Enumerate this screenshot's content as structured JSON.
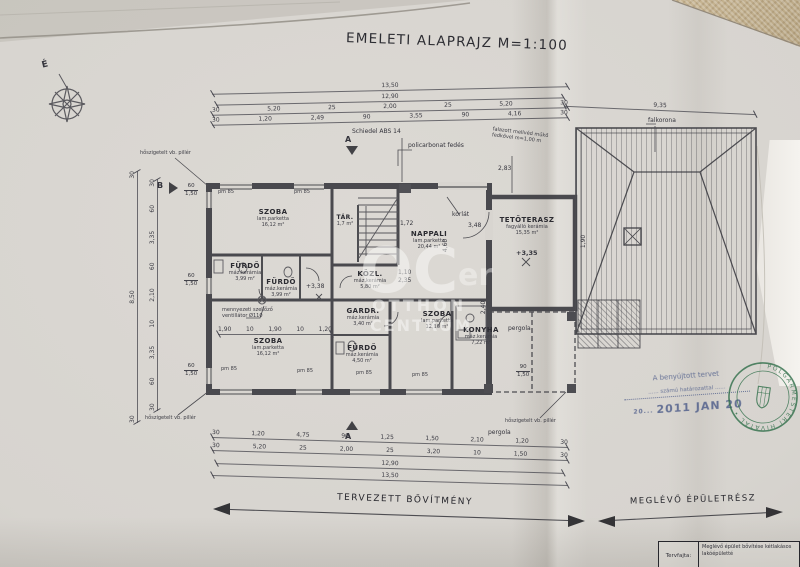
{
  "title": "EMELETI ALAPRAJZ M=1:100",
  "compass_label": "É",
  "watermark": {
    "big": "OC",
    "line1": "OTTHON",
    "line2": "CENTRUM",
    "fragment": "er"
  },
  "rooms": [
    {
      "name": "SZOBA",
      "finish": "lam.parketta",
      "area": "16,12 m²"
    },
    {
      "name": "TÁR.",
      "finish": "",
      "area": "1,7 m²"
    },
    {
      "name": "NAPPALI",
      "finish": "lam.parketta",
      "area": "20,44 m²"
    },
    {
      "name": "TETŐTERASZ",
      "finish": "fagyálló kerámia",
      "area": "15,35 m²",
      "level": "+3,35"
    },
    {
      "name": "FÜRDŐ",
      "finish": "máz.kerámia",
      "area": "3,99 m²"
    },
    {
      "name": "FÜRDŐ",
      "finish": "máz.kerámia",
      "area": "3,99 m²"
    },
    {
      "name": "KÖZL.",
      "finish": "máz.kerámia",
      "area": "5,80 m²"
    },
    {
      "name": "GARDR.",
      "finish": "máz.kerámia",
      "area": "3,40 m²"
    },
    {
      "name": "SZOBA",
      "finish": "lam.parketta",
      "area": "12,16 m²"
    },
    {
      "name": "KONYHA",
      "finish": "máz.kerámia",
      "area": "7,22 m²"
    },
    {
      "name": "FÜRDŐ",
      "finish": "máz.kerámia",
      "area": "4,50 m²"
    },
    {
      "name": "SZOBA",
      "finish": "lam.parketta",
      "area": "16,12 m²"
    }
  ],
  "annotations": {
    "schiedel": "Schiedel ABS 14",
    "policarbonat": "policarbonat fedés",
    "mellved": "falazott mellvéd műkő fedkővel m=1,00 m",
    "pillar": "hőszigetelt vb. pillér",
    "korlat": "korlát",
    "pergola": "pergola",
    "vent": "mennyezeti szellőző ventillátor Ø110",
    "falkorona": "falkorona",
    "level_hall": "+3,38",
    "pm85": "pm 85",
    "wtop": "60",
    "wtop2": "90",
    "wbot": "1,50",
    "dim283": "2,83",
    "dim172": "1,72",
    "dim348": "3,48",
    "dim460": "4,60",
    "dim240": "2,40",
    "dim190": "1,90",
    "dim110": "1,10",
    "dim235": "2,35",
    "marker_a": "A",
    "marker_b": "B"
  },
  "dims": {
    "top_total": "13,50",
    "top_sub": "12,90",
    "top_row3": [
      "30",
      "5,20",
      "25",
      "2,00",
      "25",
      "5,20",
      "30"
    ],
    "top_row4": [
      "30",
      "1,20",
      "2,49",
      "90",
      "3,55",
      "90",
      "4,16",
      "30"
    ],
    "roof_width": "9,35",
    "bottom_row1": [
      "30",
      "1,20",
      "4,75",
      "90",
      "1,25",
      "1,50",
      "2,10",
      "1,20",
      "30"
    ],
    "bottom_row2": [
      "30",
      "5,20",
      "25",
      "2,00",
      "25",
      "3,20",
      "10",
      "1,50",
      "30"
    ],
    "bottom_sub": "12,90",
    "bottom_total": "13,50",
    "left_chain": [
      "30",
      "60",
      "3,35",
      "10",
      "2,10",
      "60",
      "3,35",
      "60",
      "30"
    ],
    "left_total": [
      "30",
      "8,50",
      "30"
    ],
    "interior_row": [
      "1,90",
      "10",
      "1,90",
      "10",
      "1,20"
    ]
  },
  "legend": {
    "new_part": "TERVEZETT BŐVÍTMÉNY",
    "existing_part": "MEGLÉVŐ ÉPÜLETRÉSZ"
  },
  "stamps": {
    "approval_line1": "A benyújtott tervet",
    "approval_line2": "...... számú határozattal ......",
    "approval_date_prefix": "20...",
    "approval_date": "2011 JAN 20",
    "round_text": "POLGÁRMESTERI HIVATAL •"
  },
  "titleblock": {
    "label": "Tervfajta:",
    "line1": "Meglévő épület bővítése kétlakásos",
    "line2": "lakóépületté"
  }
}
